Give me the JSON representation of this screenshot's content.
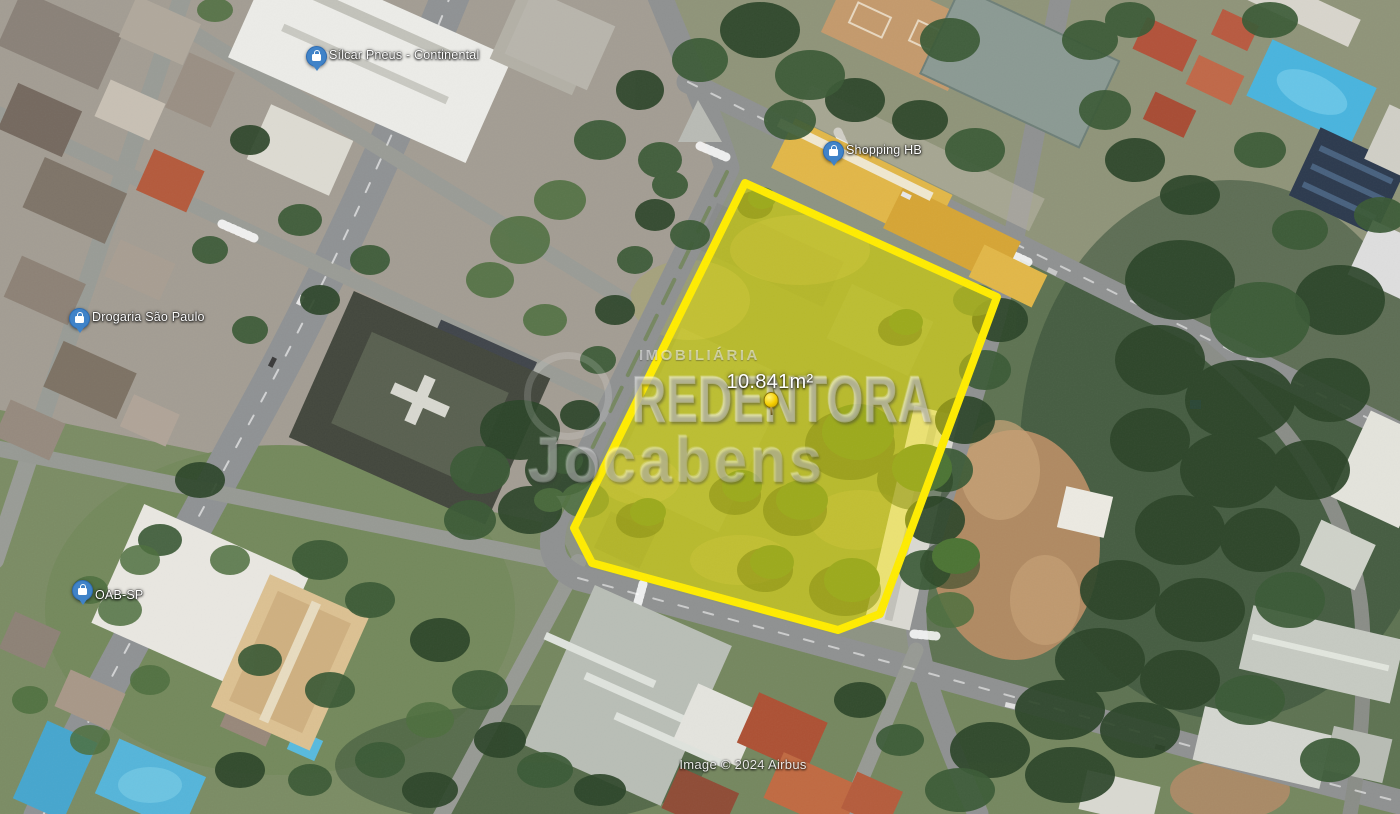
{
  "pois": [
    {
      "label": "Sílcar Pneus - Continental",
      "icon": "shopping-bag-icon"
    },
    {
      "label": "Shopping HB",
      "icon": "shopping-bag-icon"
    },
    {
      "label": "Drogaria São Paulo",
      "icon": "shopping-bag-icon"
    },
    {
      "label": "OAB-SP",
      "icon": "shopping-bag-icon"
    }
  ],
  "property": {
    "area_label": "10.841m²"
  },
  "watermark": {
    "brand_small": "IMOBILIÁRIA",
    "brand_large": "REDENTORA",
    "brand_script": "Jocabens"
  },
  "attribution": "Image © 2024 Airbus",
  "colors": {
    "polygon_stroke": "#ffec00",
    "polygon_fill": "rgba(255,238,0,0.45)",
    "poi_pin_blue": "#4083c8",
    "pushpin_yellow": "#f6cf00"
  }
}
